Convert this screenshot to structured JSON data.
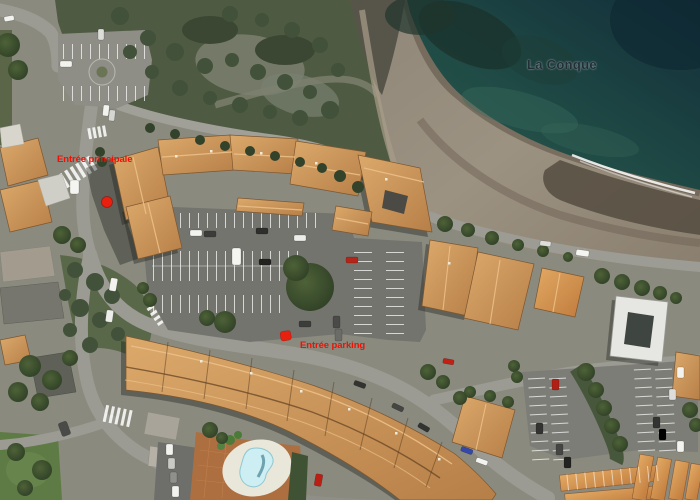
{
  "map": {
    "type": "satellite",
    "place_label": {
      "text": "La Conque",
      "color": "#232e38"
    },
    "annotations": [
      {
        "id": "main-entrance",
        "text": "Entrée principale",
        "color": "#ed1205"
      },
      {
        "id": "parking-entrance",
        "text": "Entrée parking",
        "color": "#ed1205"
      }
    ],
    "markers": [
      {
        "id": "main-entrance-dot",
        "shape": "dot",
        "color": "#e9200e"
      },
      {
        "id": "parking-entrance-square",
        "shape": "rounded-square",
        "color": "#e9200e"
      }
    ],
    "colors": {
      "water_deep": "#132e3a",
      "water_shallow": "#2d5c50",
      "beach_sand": "#948b7b",
      "roof_terracotta": "#c98e58",
      "road": "#9b9b93",
      "vegetation": "#4f5a42",
      "pool": "#cdeef2",
      "label_red": "#ed1205"
    }
  }
}
